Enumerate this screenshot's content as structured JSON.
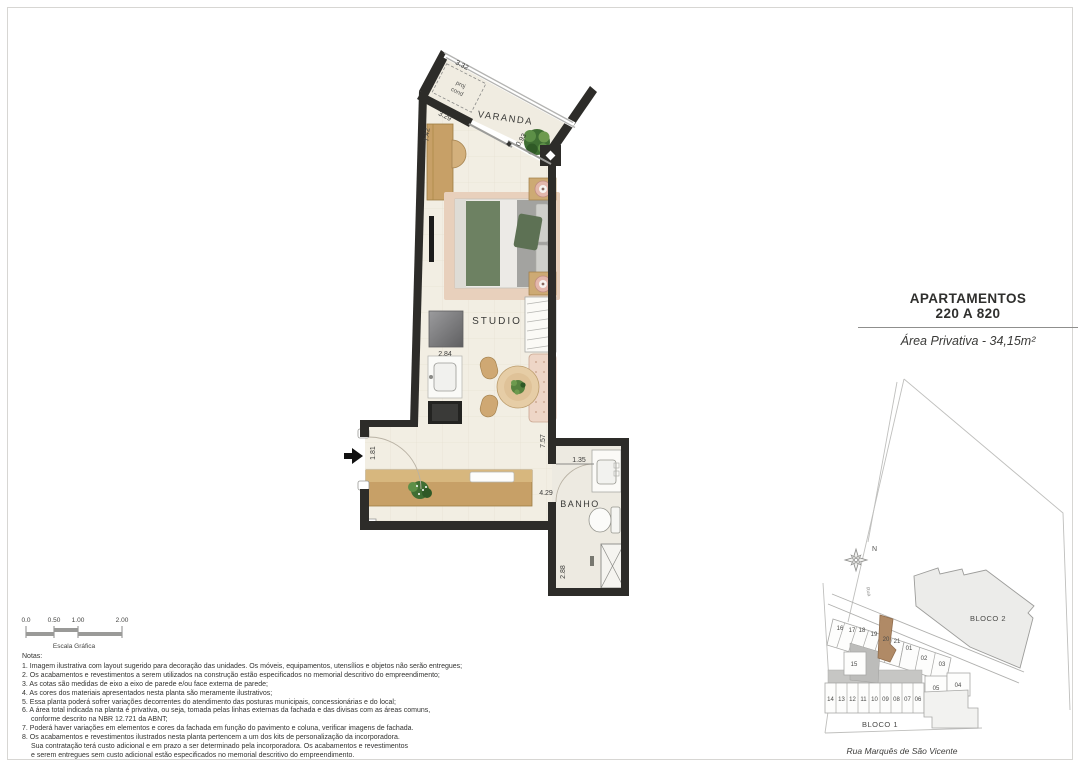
{
  "title_block": {
    "line1": "APARTAMENTOS",
    "line2": "220 A 820",
    "area": "Área Privativa - 34,15m²"
  },
  "plan": {
    "rooms": {
      "varanda": "VARANDA",
      "studio": "STUDIO",
      "banho": "BANHO"
    },
    "dimensions": [
      "3.32",
      "3.29",
      "7.42",
      "0.93",
      "2.84",
      "1.81",
      "7.57",
      "1.35",
      "4.29",
      "2.88"
    ],
    "annotations": {
      "proj_line1": "proj",
      "proj_line2": "cond"
    },
    "colors": {
      "wall": "#2d2c29",
      "floor": "#f2eee3",
      "wood": "#c7a067",
      "bed_green": "#6d8162",
      "rug": "#e8d0bc"
    }
  },
  "scale_bar": {
    "ticks": [
      "0.0",
      "0.50",
      "1.00",
      "2.00"
    ],
    "caption": "Escala Gráfica"
  },
  "site_map": {
    "north": "N",
    "rua_label": "Rua",
    "bloco1": "BLOCO 1",
    "bloco2": "BLOCO 2",
    "street": "Rua Marquês de São Vicente",
    "highlighted_unit": "20",
    "colors": {
      "highlight": "#b08a66",
      "building_fill": "#ececea",
      "outline": "#a8a8a6"
    },
    "units": [
      "16",
      "17",
      "18",
      "19",
      "20",
      "21",
      "01",
      "02",
      "03",
      "15",
      "14",
      "13",
      "12",
      "11",
      "10",
      "09",
      "08",
      "07",
      "06",
      "05",
      "04"
    ]
  },
  "notes": {
    "title": "Notas:",
    "lines": [
      "1. Imagem ilustrativa com layout sugerido para decoração das unidades. Os móveis, equipamentos, utensílios e objetos não serão entregues;",
      "2. Os acabamentos e revestimentos a serem utilizados na construção estão especificados no memorial descritivo do empreendimento;",
      "3. As cotas são medidas de eixo a eixo de parede e/ou face externa de parede;",
      "4. As cores dos materiais apresentados nesta planta são meramente ilustrativos;",
      "5. Essa planta poderá sofrer variações decorrentes do atendimento das posturas municipais, concessionárias e do local;",
      "6. A área total indicada na planta é privativa, ou seja, tomada pelas linhas externas da fachada e das divisas com as áreas comuns,",
      "conforme descrito na NBR 12.721 da ABNT;",
      "7. Poderá haver variações em elementos e cores da fachada em função do pavimento e coluna, verificar imagens de fachada.",
      "8. Os acabamentos e revestimentos ilustrados nesta planta pertencem a um dos kits de personalização da incorporadora.",
      "Sua contratação terá custo adicional e em prazo a ser determinado pela incorporadora. Os acabamentos e revestimentos",
      "e serem entregues sem custo adicional estão especificados  no memorial descritivo do empreendimento."
    ]
  }
}
